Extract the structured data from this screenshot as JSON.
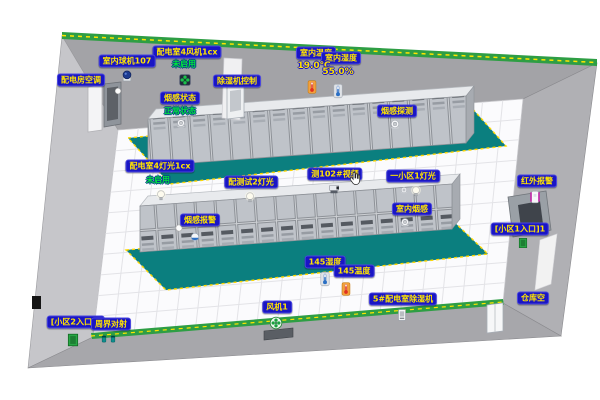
{
  "tags": [
    "配电室4风机1cx",
    "室内球机107",
    "配电房空调",
    "除湿机控制",
    "烟感状态",
    "室内温度",
    "室内湿度",
    "烟感探测",
    "配电室4灯光1cx",
    "配测试2灯光",
    "测102#视频",
    "一小区1灯光",
    "红外报警",
    "[小区1入口]1",
    "烟感报警",
    "室内烟感",
    "145湿度",
    "145温度",
    "风机1",
    "5#配电室除湿机",
    "仓库空",
    "[小区2入口]2",
    "周界对射"
  ],
  "statuses": {
    "fan_top": "未启用",
    "smoke_normal": "正常状态",
    "light_disabled": "未启用"
  },
  "values": {
    "indoor_temperature": "19.0℃",
    "indoor_humidity": "55.0%"
  },
  "colors": {
    "label_background": "#1a16c4",
    "label_text": "#ffe400",
    "status_text": "#00e43c",
    "mat_teal": "#0b7f7f",
    "wall_strip_green": "#2e9e44",
    "dash_yellow": "#ffd700"
  },
  "icon_names": [
    "dome-camera-icon",
    "ball-camera-icon",
    "fan-icon",
    "smoke-detector-icon",
    "thermometer-icon",
    "humidity-icon",
    "bulb-icon",
    "ptz-camera-icon",
    "infrared-sensor-icon",
    "door-icon",
    "beam-sensor-icon",
    "dehumidifier-icon",
    "cursor-hand-icon"
  ]
}
